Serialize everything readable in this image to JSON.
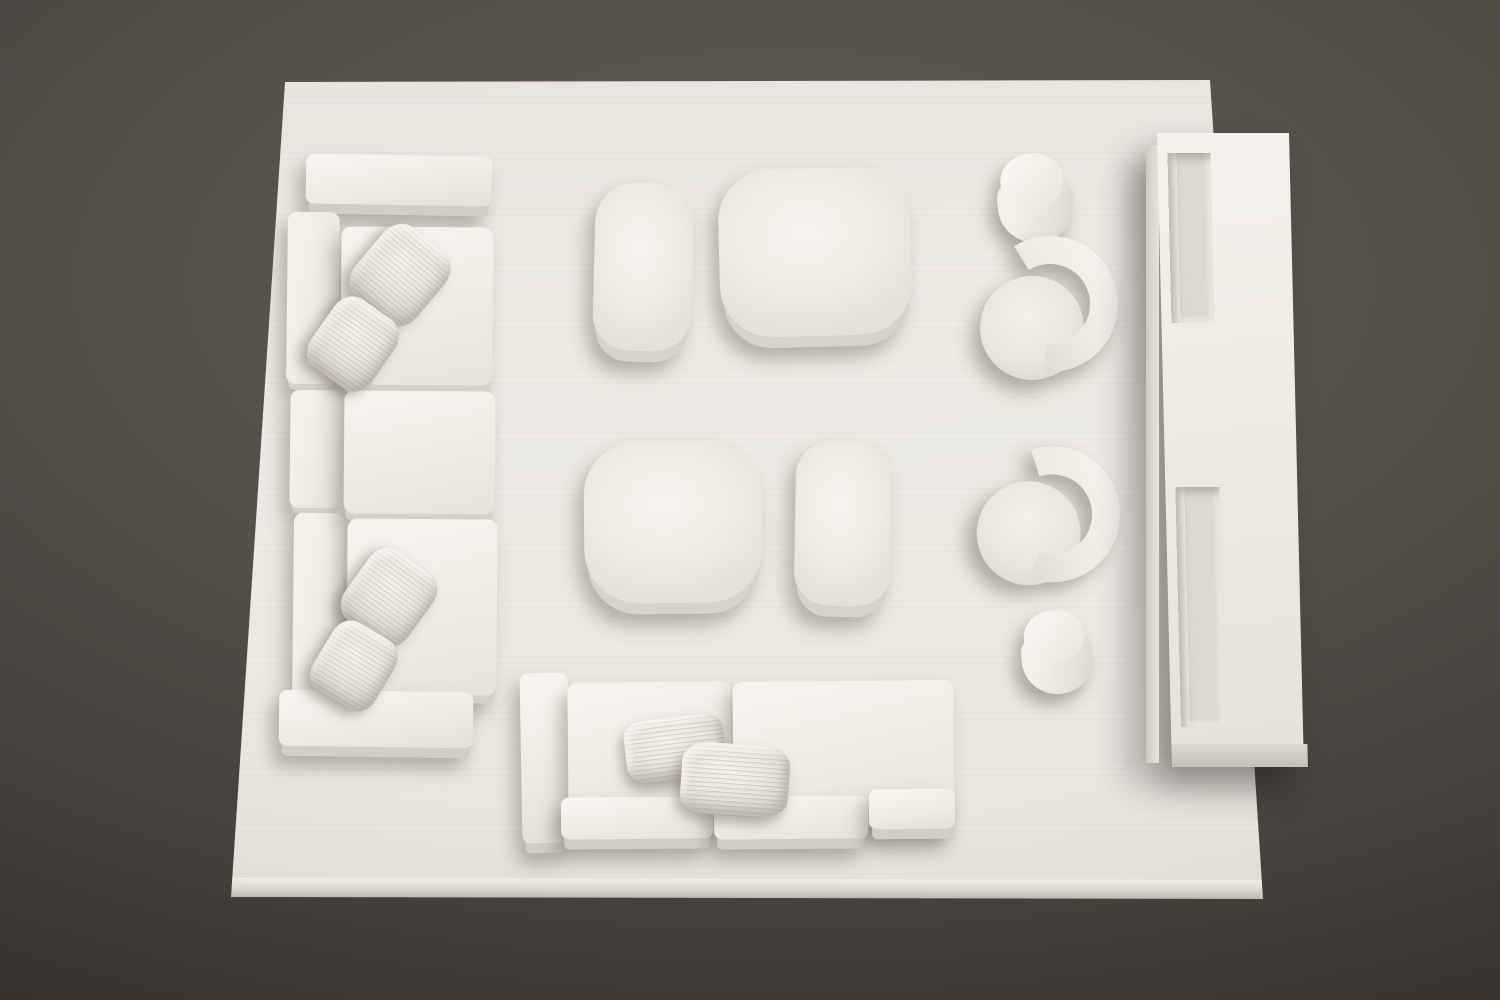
{
  "scene": {
    "type": "photograph",
    "view": "top-down",
    "description": "Monochrome white architectural scale model of a living-room furniture layout arranged on a white base board over a dark gray studio backdrop",
    "palette": {
      "backdrop_dark": "#2b2926",
      "backdrop_mid": "#53504a",
      "board_white": "#ebe8e2",
      "furniture_highlight": "#f6f3ee",
      "furniture_shadow_side": "#d6d1c8",
      "cast_shadow": "#6c6457"
    }
  },
  "objects": {
    "backdrop": {
      "label": "Dark gray studio backdrop"
    },
    "board": {
      "label": "White rectangular model base board"
    },
    "sofa_left": {
      "label": "Three-seat sectional sofa along left edge",
      "seat_cushions": 3,
      "back_cushions": 3,
      "pillows": 4,
      "arms": 2
    },
    "stool_top": {
      "label": "Oblong bench ottoman, top center"
    },
    "ottoman_top": {
      "label": "Large rounded-square ottoman, top center"
    },
    "coffee_table": {
      "label": "Rounded-square coffee table, center"
    },
    "side_table": {
      "label": "Small rounded side table, center"
    },
    "cylinder_top": {
      "label": "Cylindrical drum side table, upper right"
    },
    "chair_top": {
      "label": "Curved barrel lounge chair, upper right"
    },
    "chair_bottom": {
      "label": "Curved barrel lounge chair, middle right"
    },
    "cylinder_bottom": {
      "label": "Cylindrical drum stool, lower right"
    },
    "sofa_bottom": {
      "label": "Wide sofa along bottom edge",
      "seat_slabs": 2,
      "front_cushions": 3,
      "pillows": 2,
      "arms": 1
    },
    "console": {
      "label": "Tall media console with recessed shelves, right edge",
      "recessed_shelves": 2
    }
  }
}
